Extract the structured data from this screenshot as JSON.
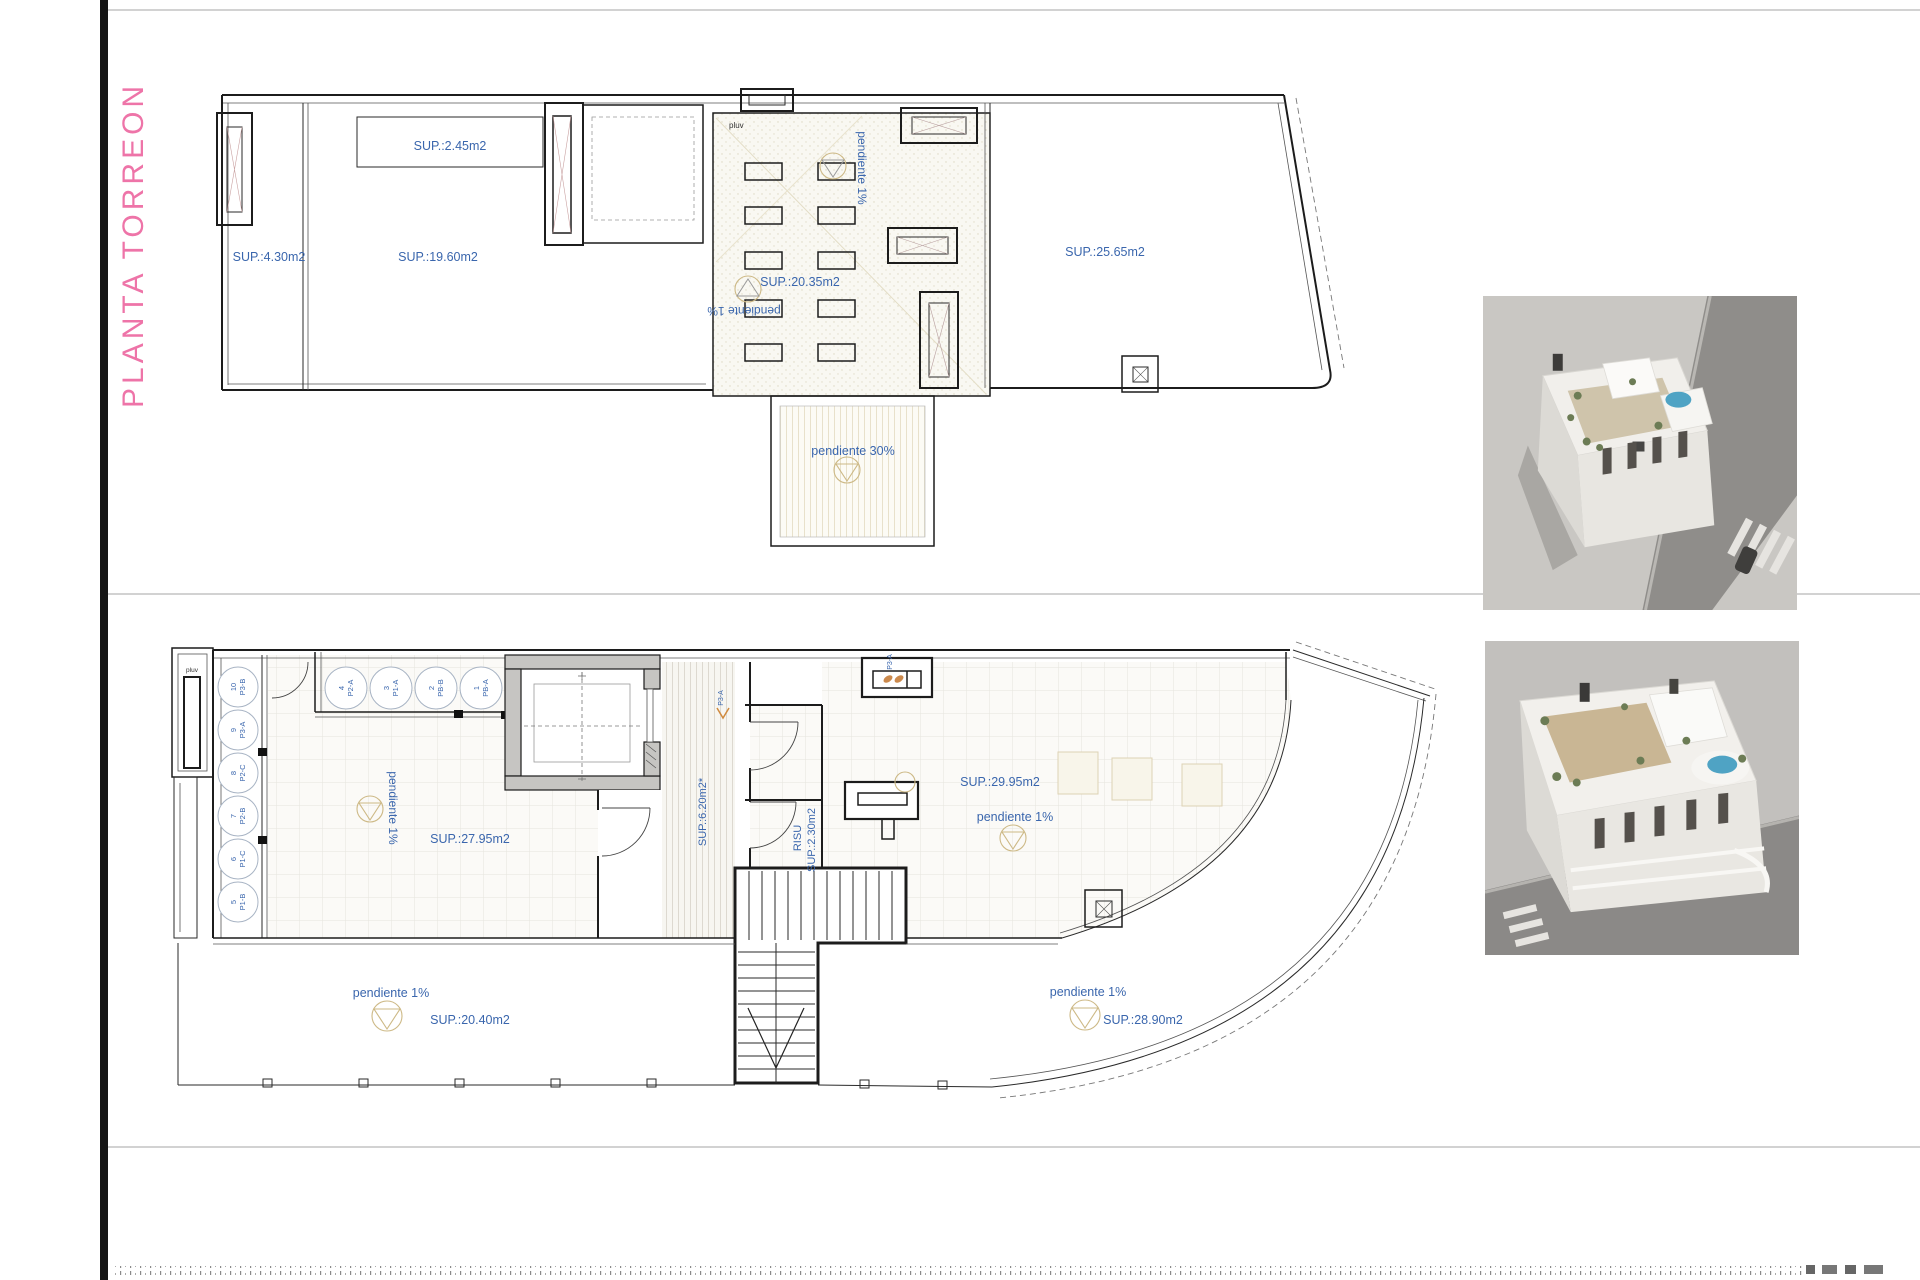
{
  "title": {
    "text": "PLANTA TORREON"
  },
  "upper_plan": {
    "sup_2_45": "SUP.:2.45m2",
    "sup_4_30": "SUP.:4.30m2",
    "sup_19_60": "SUP.:19.60m2",
    "pluv": "pluv",
    "pendiente_1_vertical": "pendiente 1%",
    "sup_20_35": "SUP.:20.35m2",
    "pendiente_1_inverted": "pendiente 1%",
    "sup_25_65": "SUP.:25.65m2",
    "pendiente_30": "pendiente 30%"
  },
  "lower_plan": {
    "pluv": "pluv",
    "left_spots": [
      {
        "num": "10",
        "code": "P3-B"
      },
      {
        "num": "9",
        "code": "P3-A"
      },
      {
        "num": "8",
        "code": "P2-C"
      },
      {
        "num": "7",
        "code": "P2-B"
      },
      {
        "num": "6",
        "code": "P1-C"
      },
      {
        "num": "5",
        "code": "P1-B"
      }
    ],
    "top_spots": [
      {
        "num": "4",
        "code": "P2-A"
      },
      {
        "num": "3",
        "code": "P1-A"
      },
      {
        "num": "2",
        "code": "PB-B"
      },
      {
        "num": "1",
        "code": "PB-A"
      }
    ],
    "wall_unit_tag": "P3-A",
    "corridor_tag": "P3-A",
    "sup_6_20": "SUP.:6.20m2*",
    "risu_line1": "RISU",
    "risu_line2": "SUP.:2.30m2",
    "sup_29_95": "SUP.:29.95m2",
    "pendiente_1_upper_right": "pendiente 1%",
    "pendiente_1_upper_left": "pendiente 1%",
    "sup_27_95": "SUP.:27.95m2",
    "pendiente_1_lower_left": "pendiente 1%",
    "sup_20_40": "SUP.:20.40m2",
    "pendiente_1_lower_right": "pendiente 1%",
    "sup_28_90": "SUP.:28.90m2"
  },
  "colors": {
    "label_blue": "#3a66ad",
    "title_pink": "#ee74a8",
    "wall": "#1c1c1c",
    "drain_tan": "#cdb986",
    "concrete_gray": "#c6c5c2",
    "render_ground": "#c9c7c3",
    "render_road": "#8f8d8a",
    "render_building": "#f3f1ed",
    "render_pool": "#4fa3c4",
    "render_plants": "#6c7c55",
    "render_deck": "#c9b694"
  }
}
